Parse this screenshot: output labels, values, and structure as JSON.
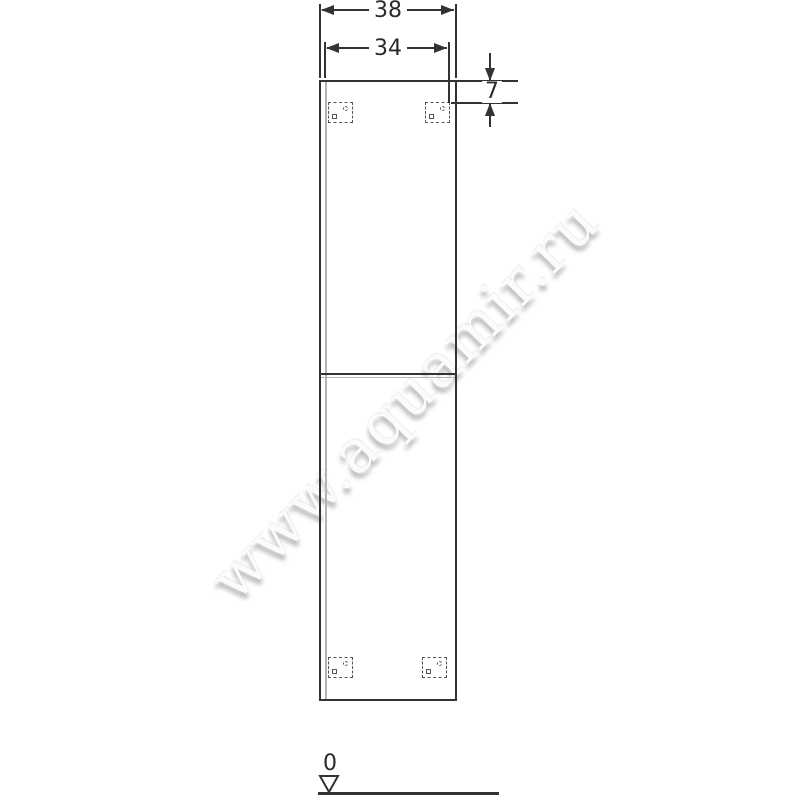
{
  "watermark": {
    "text": "www.aquamir.ru"
  },
  "dimensions": {
    "outer_width": "38",
    "inner_width": "34",
    "top_bracket_offset": "7"
  },
  "datum": {
    "zero_label": "0"
  },
  "colors": {
    "background": "#ffffff",
    "line": "#333333",
    "light_line": "#b4b4b4",
    "watermark_text": "#fbfbfb",
    "watermark_shadow": "#bdbdbd"
  }
}
